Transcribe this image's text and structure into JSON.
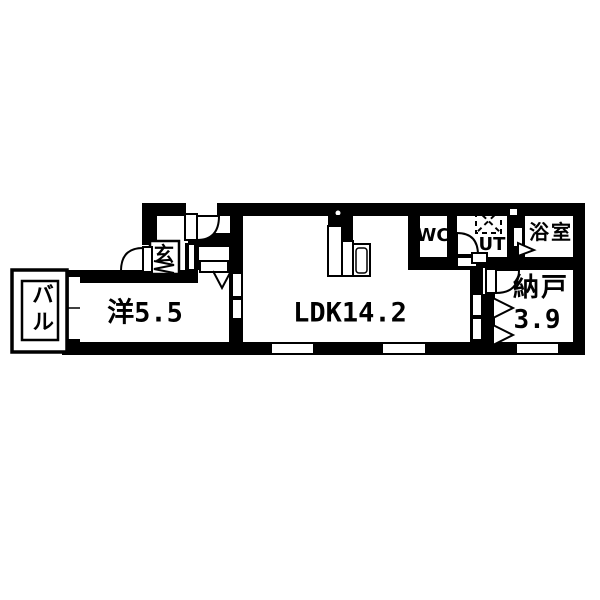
{
  "title": "apartment-floorplan",
  "colors": {
    "wall": "#000000",
    "background": "#ffffff",
    "line": "#000000"
  },
  "rooms": [
    {
      "id": "balcony",
      "label": "バル"
    },
    {
      "id": "western-room",
      "label": "洋5.5"
    },
    {
      "id": "entrance",
      "label": "玄"
    },
    {
      "id": "ldk",
      "label": "LDK14.2"
    },
    {
      "id": "wc",
      "label": "WC"
    },
    {
      "id": "utility",
      "label": "UT"
    },
    {
      "id": "bathroom",
      "label": "浴室"
    },
    {
      "id": "storage",
      "label": "納戸",
      "area": "3.9"
    }
  ]
}
